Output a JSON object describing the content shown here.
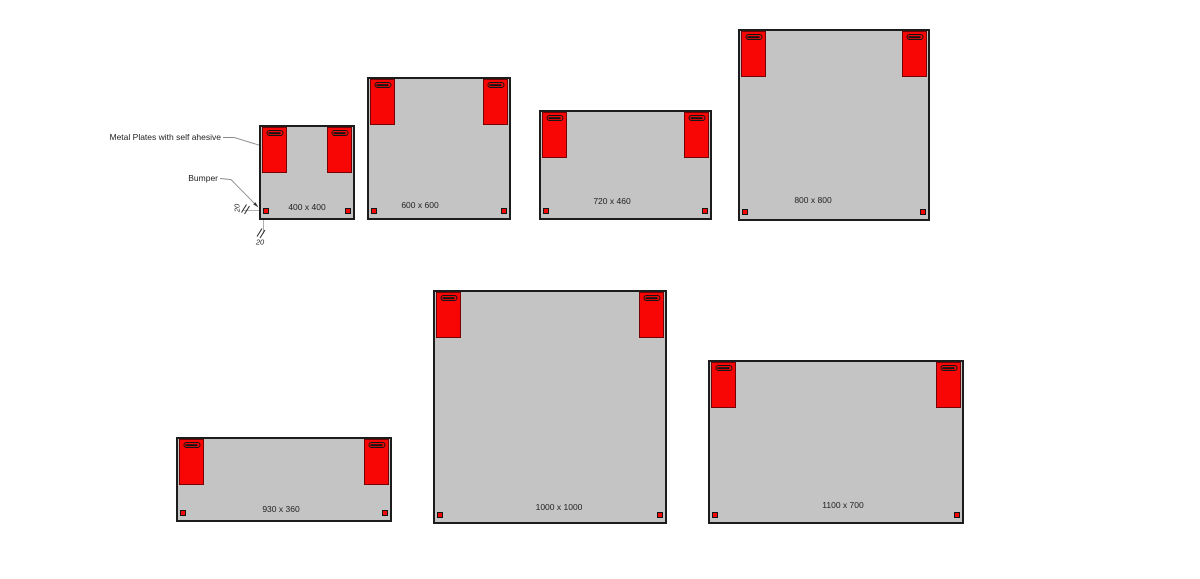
{
  "colors": {
    "red": "#f80505",
    "panel_fill": "#c4c4c4",
    "panel_border": "#1c1c1c",
    "text": "#1f1f1f"
  },
  "annotations": {
    "metal_plates_label": "Metal Plates with self ahesive",
    "bumper_label": "Bumper",
    "dim_side": "20",
    "dim_bottom": "20"
  },
  "panels": [
    {
      "label": "400 x 400",
      "size_units": [
        400,
        400
      ],
      "x": 259,
      "y": 125,
      "w": 96,
      "h": 95,
      "label_cx": 307,
      "label_cy": 207
    },
    {
      "label": "600 x 600",
      "size_units": [
        600,
        600
      ],
      "x": 367,
      "y": 77,
      "w": 144,
      "h": 143,
      "label_cx": 420,
      "label_cy": 205
    },
    {
      "label": "720 x 460",
      "size_units": [
        720,
        460
      ],
      "x": 539,
      "y": 110,
      "w": 173,
      "h": 110,
      "label_cx": 612,
      "label_cy": 201
    },
    {
      "label": "800 x 800",
      "size_units": [
        800,
        800
      ],
      "x": 738,
      "y": 29,
      "w": 192,
      "h": 192,
      "label_cx": 813,
      "label_cy": 200
    },
    {
      "label": "930 x 360",
      "size_units": [
        930,
        360
      ],
      "x": 176,
      "y": 437,
      "w": 216,
      "h": 85,
      "label_cx": 281,
      "label_cy": 509
    },
    {
      "label": "1000 x 1000",
      "size_units": [
        1000,
        1000
      ],
      "x": 433,
      "y": 290,
      "w": 234,
      "h": 234,
      "label_cx": 559,
      "label_cy": 507
    },
    {
      "label": "1100 x 700",
      "size_units": [
        1100,
        700
      ],
      "x": 708,
      "y": 360,
      "w": 256,
      "h": 164,
      "label_cx": 843,
      "label_cy": 505
    }
  ]
}
